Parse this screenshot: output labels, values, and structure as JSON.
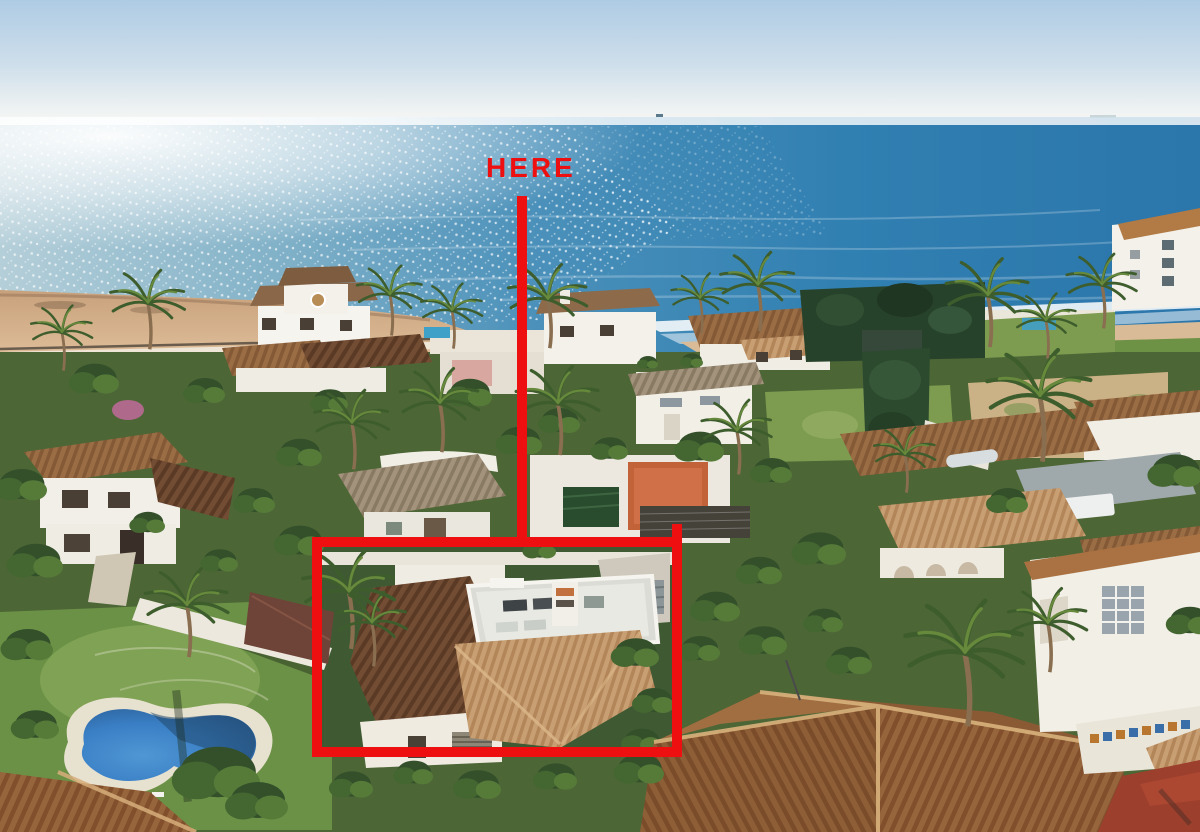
{
  "annotations": {
    "here_label": "HERE",
    "marker_color": "#ee1010"
  },
  "scene": {
    "type": "aerial-photo-beachfront-villas",
    "sky_top_color": "#aecbe4",
    "sky_horizon_color": "#f5f6f4",
    "sea_deep_color": "#2b76ab",
    "sea_glitter_color": "#ffffff",
    "beach_sand_color": "#d9b48c",
    "lawn_color": "#7d9c50",
    "dark_roof_color": "#6e4a33",
    "terracotta_roof_color": "#a5683c",
    "pale_roof_color": "#c69a6b",
    "white_wall_color": "#f2efe7",
    "pool_water_color": "#3f86c4",
    "vegetation_color": "#41602f"
  }
}
